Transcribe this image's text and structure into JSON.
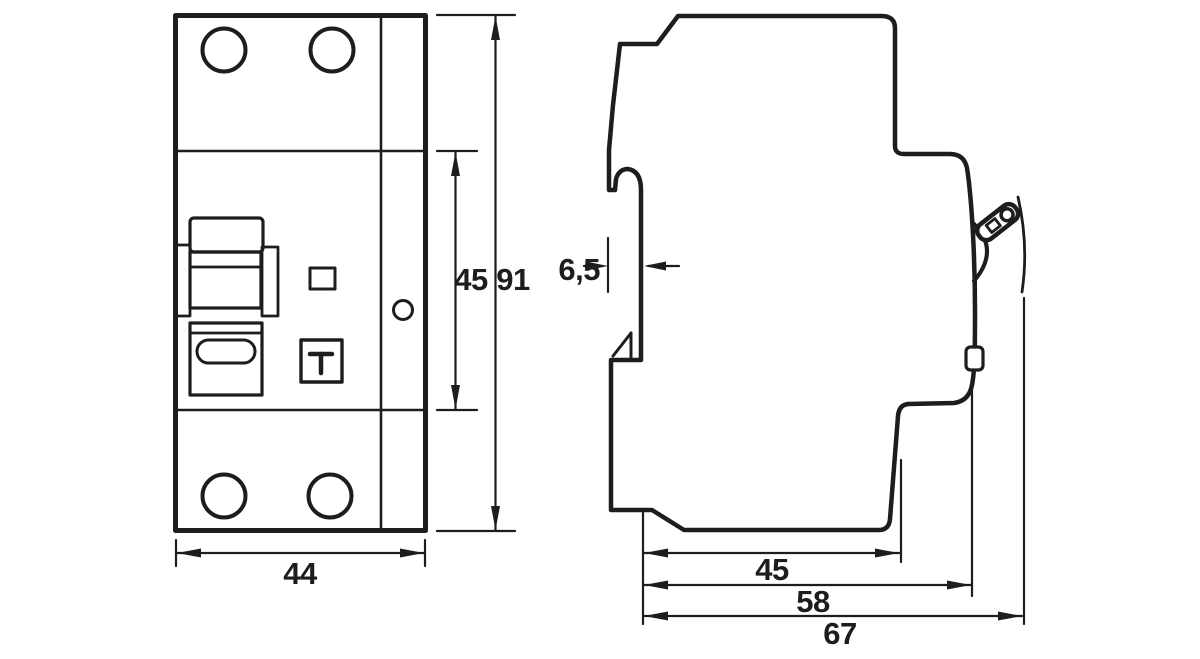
{
  "page": {
    "background": "#ffffff",
    "line_color": "#1d1d1b",
    "description": "Dimensional drawing of a DIN-rail circuit breaker, front view and side view"
  },
  "dims": {
    "front_width": "44",
    "front_section_height": "45",
    "front_total_height": "91",
    "side_rail_offset": "6,5",
    "side_rail_seat_depth": "45",
    "side_body_depth": "58",
    "side_total_depth": "67"
  }
}
